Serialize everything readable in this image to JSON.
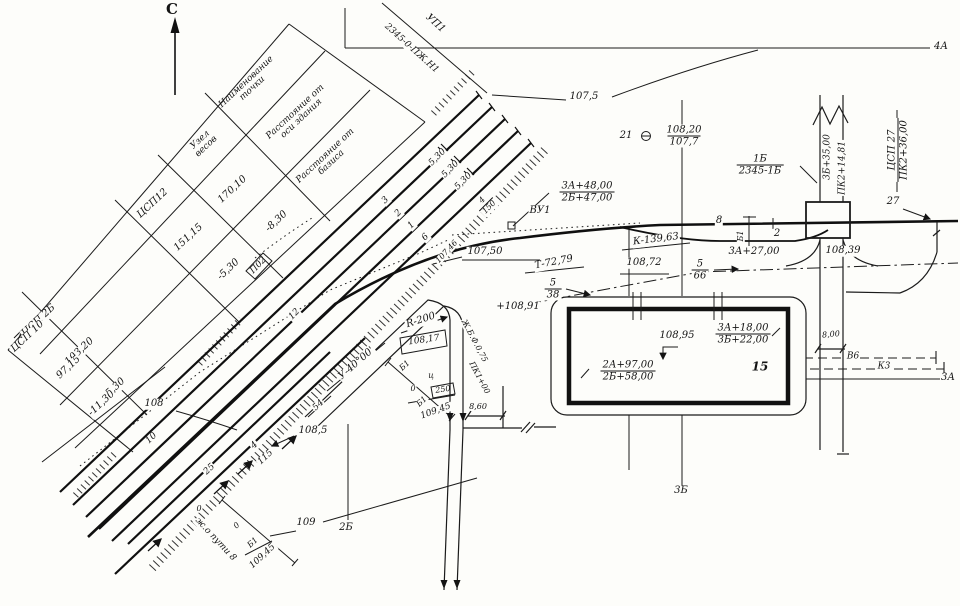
{
  "north_label": "С",
  "table": {
    "headers": {
      "name": "Наименование точки",
      "axis": "Расстояние от оси здания",
      "basis": "Расстояние от базиса"
    },
    "rows": [
      {
        "name": "Узел весов",
        "axis": "170,10",
        "basis": "-8,30"
      },
      {
        "name": "ЦСП12",
        "axis": "151,15",
        "basis": "-5,30"
      },
      {
        "name": "ЦСП 2Б",
        "axis": "103,20",
        "basis": "5,30"
      },
      {
        "name": "ЦСП 10",
        "axis": "97,15",
        "basis": "-11,30"
      }
    ]
  },
  "contours": {
    "c107_5": "107,5",
    "c107_46": "107,46",
    "c107_50": "107,50",
    "c108": "108",
    "c108_5": "108,5",
    "c109": "109"
  },
  "alignment": {
    "up1": "УП1",
    "up1_code": "2345-0-ПЖ.Н1",
    "axis_4a": "4А",
    "axis_3a": "3А",
    "axis_3b": "3Б",
    "axis_2b": "2Б",
    "vu1": "ВУ1",
    "vu1_sta": {
      "top": "3А+48,00",
      "bot": "2Б+47,00"
    },
    "curve_k": "К-139,63",
    "curve_t": "Т-72,79",
    "angle": "У-40°00'",
    "radius": "R-200",
    "sta_3a27": "3А+27,00",
    "el_108_39": "108,39",
    "el_108_72": "108,72",
    "el_108_91": "+108,91",
    "el_108_17": "108,17",
    "grade_66": {
      "top": "5",
      "bot": "66"
    },
    "grade_38": {
      "top": "5",
      "bot": "38"
    },
    "grade_150": {
      "top": "4",
      "bot": "150"
    }
  },
  "points": {
    "p21": {
      "num": "21",
      "top": "108,20",
      "bot": "107,7"
    },
    "p1b": {
      "top": "1Б",
      "bot": "2345-1Б"
    },
    "csp27": {
      "top": "ЦСП 27",
      "bot": "ПК2+36,00"
    },
    "road_sta": "3Б+35,00",
    "road_pk": "ПК2+14,81"
  },
  "tracks": {
    "n1": "1",
    "n2": "2",
    "n3": "3",
    "n4": "4",
    "n6": "6",
    "n8": "8",
    "n10": "10",
    "n12": "12",
    "n27": "27",
    "gauge": "5,30",
    "len115": "115",
    "len25": "25",
    "way8": "ж.о пути 8",
    "p02": "П02"
  },
  "roads": {
    "culvert": "Ж.Б.Ф.0,75",
    "pk1": "ПК1+00"
  },
  "bases": {
    "b1": "Б1",
    "c": "ц",
    "zero": "0",
    "d250": "250",
    "el": "109,45",
    "slope54": "54"
  },
  "building": {
    "el": "108,95",
    "f1": {
      "top": "3А+18,00",
      "bot": "3Б+22,00"
    },
    "f2": {
      "top": "2А+97,00",
      "bot": "2Б+58,00"
    },
    "num": "15"
  },
  "utilities": {
    "v6": "В6",
    "k3": "К3"
  },
  "dims": {
    "d860": "8,60",
    "d800": "8,00"
  }
}
